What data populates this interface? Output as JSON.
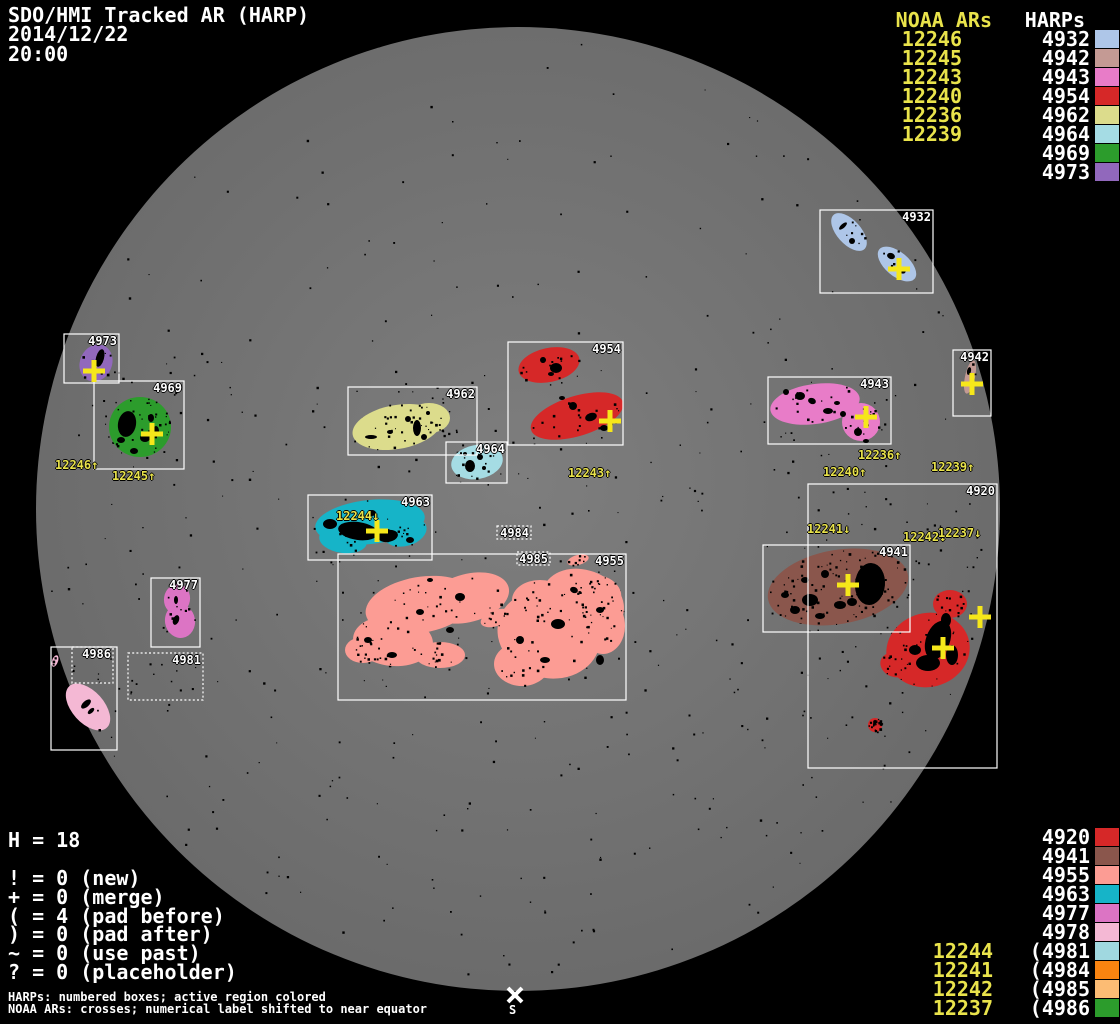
{
  "chart_data": {
    "type": "table",
    "title": "SDO/HMI Tracked AR (HARP)",
    "date": "2014/12/22",
    "time": "20:00",
    "columns": [
      "NOAA AR",
      "HARP"
    ],
    "legend_top_rows": [
      [
        "12246",
        "4932"
      ],
      [
        "12245",
        "4942"
      ],
      [
        "12243",
        "4943"
      ],
      [
        "12240",
        "4954"
      ],
      [
        "12236",
        "4962"
      ],
      [
        "12239",
        "4964"
      ],
      [
        "",
        "4969"
      ],
      [
        "",
        "4973"
      ]
    ],
    "legend_bottom_rows": [
      [
        "",
        "4920"
      ],
      [
        "",
        "4941"
      ],
      [
        "",
        "4955"
      ],
      [
        "",
        "4963"
      ],
      [
        "",
        "4977"
      ],
      [
        "",
        "4978"
      ],
      [
        "12244",
        "(4981"
      ],
      [
        "12241",
        "(4984"
      ],
      [
        "12242",
        "(4985"
      ],
      [
        "12237",
        "(4986"
      ]
    ],
    "stats": {
      "H": 18,
      "new": 0,
      "merge": 0,
      "pad_before": 4,
      "pad_after": 0,
      "use_past": 0,
      "placeholder": 0
    }
  },
  "header": {
    "title": "SDO/HMI Tracked AR (HARP)",
    "date": "2014/12/22",
    "time": "20:00"
  },
  "legend_top": {
    "noaa_header": "NOAA ARs",
    "harp_header": "HARPs",
    "rows": [
      {
        "noaa": "12246",
        "harp": "4932",
        "color": "#aec6e8"
      },
      {
        "noaa": "12245",
        "harp": "4942",
        "color": "#c49a94"
      },
      {
        "noaa": "12243",
        "harp": "4943",
        "color": "#e87cc8"
      },
      {
        "noaa": "12240",
        "harp": "4954",
        "color": "#d62828"
      },
      {
        "noaa": "12236",
        "harp": "4962",
        "color": "#dcdc8c"
      },
      {
        "noaa": "12239",
        "harp": "4964",
        "color": "#a5dce4"
      },
      {
        "noaa": "",
        "harp": "4969",
        "color": "#2c9c2c"
      },
      {
        "noaa": "",
        "harp": "4973",
        "color": "#9168bc"
      }
    ]
  },
  "legend_bottom": {
    "rows": [
      {
        "noaa": "",
        "harp": "4920",
        "color": "#d62828"
      },
      {
        "noaa": "",
        "harp": "4941",
        "color": "#8a564c"
      },
      {
        "noaa": "",
        "harp": "4955",
        "color": "#fc9c94"
      },
      {
        "noaa": "",
        "harp": "4963",
        "color": "#16b4c8"
      },
      {
        "noaa": "",
        "harp": "4977",
        "color": "#dc74c4"
      },
      {
        "noaa": "",
        "harp": "4978",
        "color": "#f4b8d4"
      },
      {
        "noaa": "12244",
        "harp": "(4981",
        "color": "#a0d8e0"
      },
      {
        "noaa": "12241",
        "harp": "(4984",
        "color": "#fa8410"
      },
      {
        "noaa": "12242",
        "harp": "(4985",
        "color": "#fcbc74"
      },
      {
        "noaa": "12237",
        "harp": "(4986",
        "color": "#2c9c2c"
      }
    ]
  },
  "stats": {
    "h_line": "H = 18",
    "symbol_lines": [
      "! = 0 (new)",
      "+ = 0 (merge)",
      "( = 4 (pad before)",
      ") = 0 (pad after)",
      "~ = 0 (use past)",
      "? = 0 (placeholder)"
    ]
  },
  "footer": {
    "line1": "HARPs: numbered boxes; active region colored",
    "line2": "NOAA ARs: crosses; numerical label shifted to near equator"
  },
  "south_marker": {
    "symbol": "S",
    "x": 515,
    "y": 995
  },
  "disk": {
    "cx": 518,
    "cy": 509,
    "r": 482,
    "color_center": "#7e7e7e",
    "color_edge": "#6a6a6a",
    "background": "#000000"
  },
  "colors": {
    "noaa_text": "#e9e34b",
    "cross": "#f6e71a",
    "box_border": "#ffffff",
    "harp_label_text": "#ffffff",
    "speckle": "#000000"
  },
  "speckles": {
    "count": 520,
    "seed": 11
  },
  "noaa_disk_labels": [
    {
      "text": "12246↑",
      "x": 55,
      "y": 459
    },
    {
      "text": "12245↑",
      "x": 112,
      "y": 470
    },
    {
      "text": "12243↑",
      "x": 568,
      "y": 467
    },
    {
      "text": "12244↓",
      "x": 336,
      "y": 510
    },
    {
      "text": "12236↑",
      "x": 858,
      "y": 449
    },
    {
      "text": "12240↑",
      "x": 823,
      "y": 466
    },
    {
      "text": "12239↑",
      "x": 931,
      "y": 461
    },
    {
      "text": "12241↓",
      "x": 807,
      "y": 523
    },
    {
      "text": "12242↓",
      "x": 903,
      "y": 531
    },
    {
      "text": "12237↓",
      "x": 938,
      "y": 527
    }
  ],
  "crosses": [
    {
      "x": 899,
      "y": 269
    },
    {
      "x": 94,
      "y": 371
    },
    {
      "x": 152,
      "y": 434
    },
    {
      "x": 610,
      "y": 421
    },
    {
      "x": 377,
      "y": 531
    },
    {
      "x": 866,
      "y": 417
    },
    {
      "x": 972,
      "y": 384
    },
    {
      "x": 848,
      "y": 585
    },
    {
      "x": 980,
      "y": 617
    },
    {
      "x": 943,
      "y": 648
    }
  ],
  "regions": [
    {
      "harp": "4932",
      "label": "4932",
      "style": "solid",
      "color": "#aec6e8",
      "box": [
        820,
        210,
        113,
        83
      ],
      "blobs": [
        [
          849,
          232,
          23,
          12,
          48
        ],
        [
          897,
          264,
          23,
          12,
          40
        ]
      ],
      "cores": [
        [
          843,
          226,
          2,
          5,
          48
        ],
        [
          852,
          241,
          3,
          3,
          0
        ],
        [
          891,
          256,
          4,
          3,
          20
        ],
        [
          901,
          270,
          5,
          3,
          30
        ]
      ],
      "speckle": 10,
      "box_speckle": 4
    },
    {
      "harp": "4973",
      "label": "4973",
      "style": "solid",
      "color": "#9168bc",
      "box": [
        64,
        334,
        55,
        49
      ],
      "blobs": [
        [
          96,
          363,
          16,
          19,
          25
        ]
      ],
      "cores": [
        [
          100,
          358,
          4,
          9,
          15
        ]
      ],
      "speckle": 6,
      "box_speckle": 2
    },
    {
      "harp": "4969",
      "label": "4969",
      "style": "solid",
      "color": "#2c9c2c",
      "box": [
        94,
        381,
        90,
        88
      ],
      "blobs": [
        [
          140,
          427,
          31,
          30,
          0
        ]
      ],
      "cores": [
        [
          127,
          424,
          9,
          13,
          10
        ],
        [
          145,
          438,
          5,
          4,
          0
        ],
        [
          151,
          418,
          3,
          4,
          0
        ],
        [
          134,
          451,
          4,
          3,
          0
        ],
        [
          156,
          431,
          3,
          5,
          0
        ],
        [
          121,
          440,
          4,
          3,
          0
        ]
      ],
      "speckle": 40,
      "box_speckle": 6
    },
    {
      "harp": "4962",
      "label": "4962",
      "style": "solid",
      "color": "#dcdc8c",
      "box": [
        348,
        387,
        129,
        68
      ],
      "blobs": [
        [
          397,
          427,
          45,
          22,
          -10
        ],
        [
          429,
          418,
          21,
          15,
          0
        ]
      ],
      "cores": [
        [
          417,
          428,
          4,
          8,
          0
        ],
        [
          424,
          437,
          3,
          3,
          0
        ],
        [
          408,
          419,
          3,
          3,
          0
        ],
        [
          371,
          437,
          6,
          2,
          0
        ],
        [
          428,
          413,
          2,
          2,
          0
        ],
        [
          390,
          432,
          3,
          2,
          0
        ]
      ],
      "speckle": 30,
      "box_speckle": 12
    },
    {
      "harp": "4964",
      "label": "4964",
      "style": "solid",
      "color": "#a5dce4",
      "box": [
        446,
        442,
        61,
        41
      ],
      "blobs": [
        [
          477,
          462,
          26,
          17,
          -10
        ]
      ],
      "cores": [
        [
          470,
          466,
          5,
          6,
          0
        ],
        [
          480,
          457,
          3,
          3,
          0
        ],
        [
          465,
          454,
          2,
          2,
          0
        ],
        [
          484,
          468,
          2,
          2,
          0
        ]
      ],
      "speckle": 12,
      "box_speckle": 3
    },
    {
      "harp": "4954",
      "label": "4954",
      "style": "solid",
      "color": "#d62828",
      "box": [
        508,
        342,
        115,
        103
      ],
      "blobs": [
        [
          549,
          365,
          31,
          17,
          -12
        ],
        [
          577,
          416,
          48,
          20,
          -17
        ]
      ],
      "cores": [
        [
          556,
          368,
          6,
          5,
          0
        ],
        [
          543,
          360,
          3,
          3,
          10
        ],
        [
          573,
          406,
          4,
          4,
          0
        ],
        [
          591,
          417,
          6,
          4,
          -20
        ],
        [
          604,
          428,
          4,
          3,
          0
        ],
        [
          562,
          398,
          3,
          2,
          0
        ],
        [
          551,
          374,
          3,
          2,
          0
        ]
      ],
      "speckle": 28,
      "box_speckle": 10
    },
    {
      "harp": "4963",
      "label": "4963",
      "style": "solid",
      "color": "#16b4c8",
      "box": [
        308,
        495,
        124,
        65
      ],
      "blobs": [
        [
          370,
          522,
          55,
          22,
          -6
        ],
        [
          343,
          540,
          24,
          13,
          8
        ],
        [
          405,
          532,
          22,
          14,
          -15
        ]
      ],
      "cores": [
        [
          358,
          531,
          20,
          9,
          8
        ],
        [
          388,
          536,
          10,
          6,
          -10
        ],
        [
          330,
          524,
          7,
          5,
          0
        ],
        [
          372,
          513,
          4,
          3,
          0
        ],
        [
          410,
          540,
          4,
          3,
          0
        ]
      ],
      "speckle": 22,
      "box_speckle": 5
    },
    {
      "harp": "4955",
      "label": "4955",
      "style": "solid",
      "color": "#fc9c94",
      "box": [
        338,
        554,
        288,
        146
      ],
      "blobs": [
        [
          420,
          605,
          55,
          28,
          -10
        ],
        [
          393,
          641,
          40,
          25,
          5
        ],
        [
          363,
          650,
          18,
          13,
          0
        ],
        [
          440,
          655,
          25,
          13,
          0
        ],
        [
          468,
          598,
          42,
          24,
          -15
        ],
        [
          549,
          634,
          52,
          44,
          15
        ],
        [
          583,
          602,
          42,
          32,
          20
        ],
        [
          605,
          590,
          18,
          12,
          35
        ],
        [
          540,
          600,
          28,
          20,
          0
        ],
        [
          522,
          664,
          28,
          22,
          0
        ],
        [
          603,
          626,
          22,
          28,
          0
        ],
        [
          496,
          618,
          16,
          8,
          -20
        ],
        [
          578,
          560,
          11,
          5,
          -15
        ]
      ],
      "cores": [
        [
          460,
          597,
          5,
          4,
          0
        ],
        [
          520,
          640,
          4,
          4,
          0
        ],
        [
          558,
          624,
          7,
          5,
          0
        ],
        [
          420,
          612,
          4,
          3,
          0
        ],
        [
          392,
          655,
          5,
          3,
          0
        ],
        [
          574,
          590,
          4,
          3,
          20
        ],
        [
          545,
          660,
          5,
          3,
          0
        ],
        [
          600,
          610,
          4,
          3,
          0
        ],
        [
          430,
          580,
          3,
          2,
          0
        ],
        [
          600,
          660,
          4,
          5,
          0
        ],
        [
          368,
          640,
          4,
          3,
          0
        ],
        [
          450,
          630,
          4,
          3,
          0
        ]
      ],
      "speckle": 170,
      "box_speckle": 25
    },
    {
      "harp": "4977",
      "label": "4977",
      "style": "solid",
      "color": "#dc74c4",
      "box": [
        151,
        578,
        49,
        69
      ],
      "blobs": [
        [
          177,
          599,
          13,
          15,
          10
        ],
        [
          180,
          621,
          15,
          17,
          -10
        ]
      ],
      "cores": [
        [
          176,
          600,
          2,
          4,
          0
        ],
        [
          176,
          620,
          3,
          5,
          20
        ]
      ],
      "speckle": 8,
      "box_speckle": 4
    },
    {
      "harp": "4978",
      "label": "",
      "style": "solid",
      "color": "#f4b8d4",
      "box": [
        51,
        647,
        66,
        103
      ],
      "blobs": [
        [
          88,
          707,
          28,
          16,
          48
        ],
        [
          55,
          661,
          3,
          6,
          20
        ]
      ],
      "cores": [
        [
          86,
          704,
          3,
          6,
          48
        ],
        [
          91,
          711,
          2,
          4,
          48
        ]
      ],
      "speckle": 6,
      "box_speckle": 3
    },
    {
      "harp": "4943",
      "label": "4943",
      "style": "solid",
      "color": "#e87cc8",
      "box": [
        768,
        377,
        123,
        67
      ],
      "blobs": [
        [
          815,
          404,
          45,
          20,
          -8
        ],
        [
          861,
          422,
          19,
          19,
          0
        ]
      ],
      "cores": [
        [
          800,
          396,
          5,
          4,
          0
        ],
        [
          812,
          401,
          4,
          3,
          20
        ],
        [
          828,
          411,
          5,
          3,
          0
        ],
        [
          843,
          414,
          3,
          3,
          0
        ],
        [
          858,
          432,
          4,
          4,
          0
        ],
        [
          786,
          392,
          3,
          3,
          0
        ],
        [
          866,
          441,
          3,
          2,
          0
        ],
        [
          837,
          403,
          3,
          2,
          0
        ]
      ],
      "speckle": 30,
      "box_speckle": 10
    },
    {
      "harp": "4942",
      "label": "4942",
      "style": "solid",
      "color": "#c49a94",
      "box": [
        953,
        350,
        38,
        66
      ],
      "blobs": [
        [
          970,
          377,
          5,
          17,
          12
        ]
      ],
      "cores": [
        [
          969,
          371,
          2,
          4,
          12
        ]
      ],
      "speckle": 3,
      "box_speckle": 1
    },
    {
      "harp": "4941",
      "label": "4941",
      "style": "solid",
      "color": "#8a564c",
      "box": [
        763,
        545,
        147,
        87
      ],
      "blobs": [
        [
          838,
          587,
          71,
          37,
          -10
        ]
      ],
      "cores": [
        [
          870,
          584,
          15,
          21,
          5
        ],
        [
          810,
          600,
          8,
          6,
          0
        ],
        [
          795,
          610,
          5,
          4,
          0
        ],
        [
          825,
          574,
          4,
          4,
          0
        ],
        [
          840,
          605,
          6,
          4,
          0
        ],
        [
          785,
          595,
          4,
          3,
          0
        ],
        [
          820,
          616,
          5,
          3,
          0
        ],
        [
          805,
          580,
          4,
          3,
          0
        ],
        [
          852,
          602,
          5,
          4,
          0
        ]
      ],
      "speckle": 70,
      "box_speckle": 15
    },
    {
      "harp": "4920",
      "label": "4920",
      "style": "solid",
      "color": "#d62828",
      "box": [
        808,
        484,
        189,
        284
      ],
      "blobs": [
        [
          950,
          604,
          17,
          14,
          0
        ],
        [
          928,
          650,
          42,
          37,
          -15
        ],
        [
          895,
          665,
          15,
          12,
          20
        ],
        [
          875,
          725,
          7,
          7,
          0
        ]
      ],
      "cores": [
        [
          938,
          640,
          12,
          20,
          20
        ],
        [
          928,
          663,
          12,
          8,
          0
        ],
        [
          952,
          655,
          6,
          10,
          0
        ],
        [
          946,
          620,
          5,
          7,
          0
        ],
        [
          915,
          650,
          6,
          5,
          0
        ]
      ],
      "speckle": 60,
      "box_speckle": 70
    },
    {
      "harp": "4986",
      "label": "4986",
      "style": "dotted",
      "color": "#2c9c2c",
      "box": [
        72,
        647,
        41,
        36
      ],
      "blobs": [],
      "cores": [],
      "speckle": 0,
      "box_speckle": 3
    },
    {
      "harp": "4981",
      "label": "4981",
      "style": "dotted",
      "color": "#a0d8e0",
      "box": [
        128,
        653,
        75,
        47
      ],
      "blobs": [],
      "cores": [],
      "speckle": 0,
      "box_speckle": 10
    },
    {
      "harp": "4984",
      "label": "4984",
      "style": "dotted",
      "color": "#fa8410",
      "box": [
        497,
        526,
        34,
        13
      ],
      "blobs": [],
      "cores": [],
      "speckle": 0,
      "box_speckle": 0
    },
    {
      "harp": "4985",
      "label": "4985",
      "style": "dotted",
      "color": "#fcbc74",
      "box": [
        517,
        552,
        33,
        13
      ],
      "blobs": [],
      "cores": [],
      "speckle": 0,
      "box_speckle": 0
    }
  ]
}
